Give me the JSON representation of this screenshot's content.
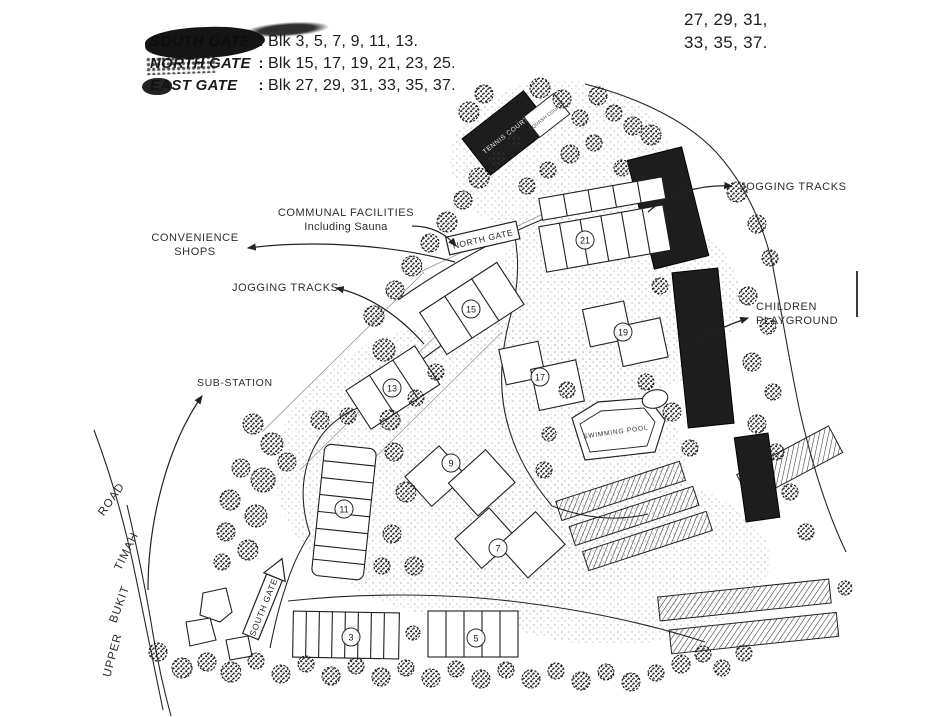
{
  "colors": {
    "ink": "#1c1c1c",
    "paper": "#ffffff"
  },
  "corner_note": {
    "line1": "27, 29, 31,",
    "line2": "33, 35, 37."
  },
  "legend": {
    "rows": [
      {
        "gate": "SOUTH GATE",
        "colon": ":",
        "blocks": "Blk 3, 5, 7, 9, 11, 13."
      },
      {
        "gate": "NORTH GATE",
        "colon": ":",
        "blocks": "Blk 15, 17, 19, 21, 23, 25."
      },
      {
        "gate": "EAST GATE",
        "colon": ":",
        "blocks": "Blk 27, 29, 31, 33, 35, 37."
      }
    ]
  },
  "callouts": {
    "jogging_tracks_right": "JOGGING TRACKS",
    "children_line1": "CHILDREN",
    "children_line2": "PLAYGROUND",
    "communal_line1": "COMMUNAL FACILITIES",
    "communal_line2": "Including Sauna",
    "convenience_line1": "CONVENIENCE",
    "convenience_line2": "SHOPS",
    "jogging_tracks_left": "JOGGING TRACKS",
    "sub_station": "SUB-STATION"
  },
  "map_labels": {
    "north_gate": "NORTH GATE",
    "south_gate": "SOUTH GATE",
    "swimming_pool": "SWIMMING POOL",
    "tennis_courts": "TENNIS COURTS",
    "squash_courts": "SQUASH COURTS",
    "road_words": [
      "UPPER",
      "BUKIT",
      "TIMAH",
      "ROAD"
    ]
  },
  "block_markers": [
    "21",
    "19",
    "17",
    "15",
    "13",
    "11",
    "9",
    "7",
    "3",
    "5"
  ]
}
